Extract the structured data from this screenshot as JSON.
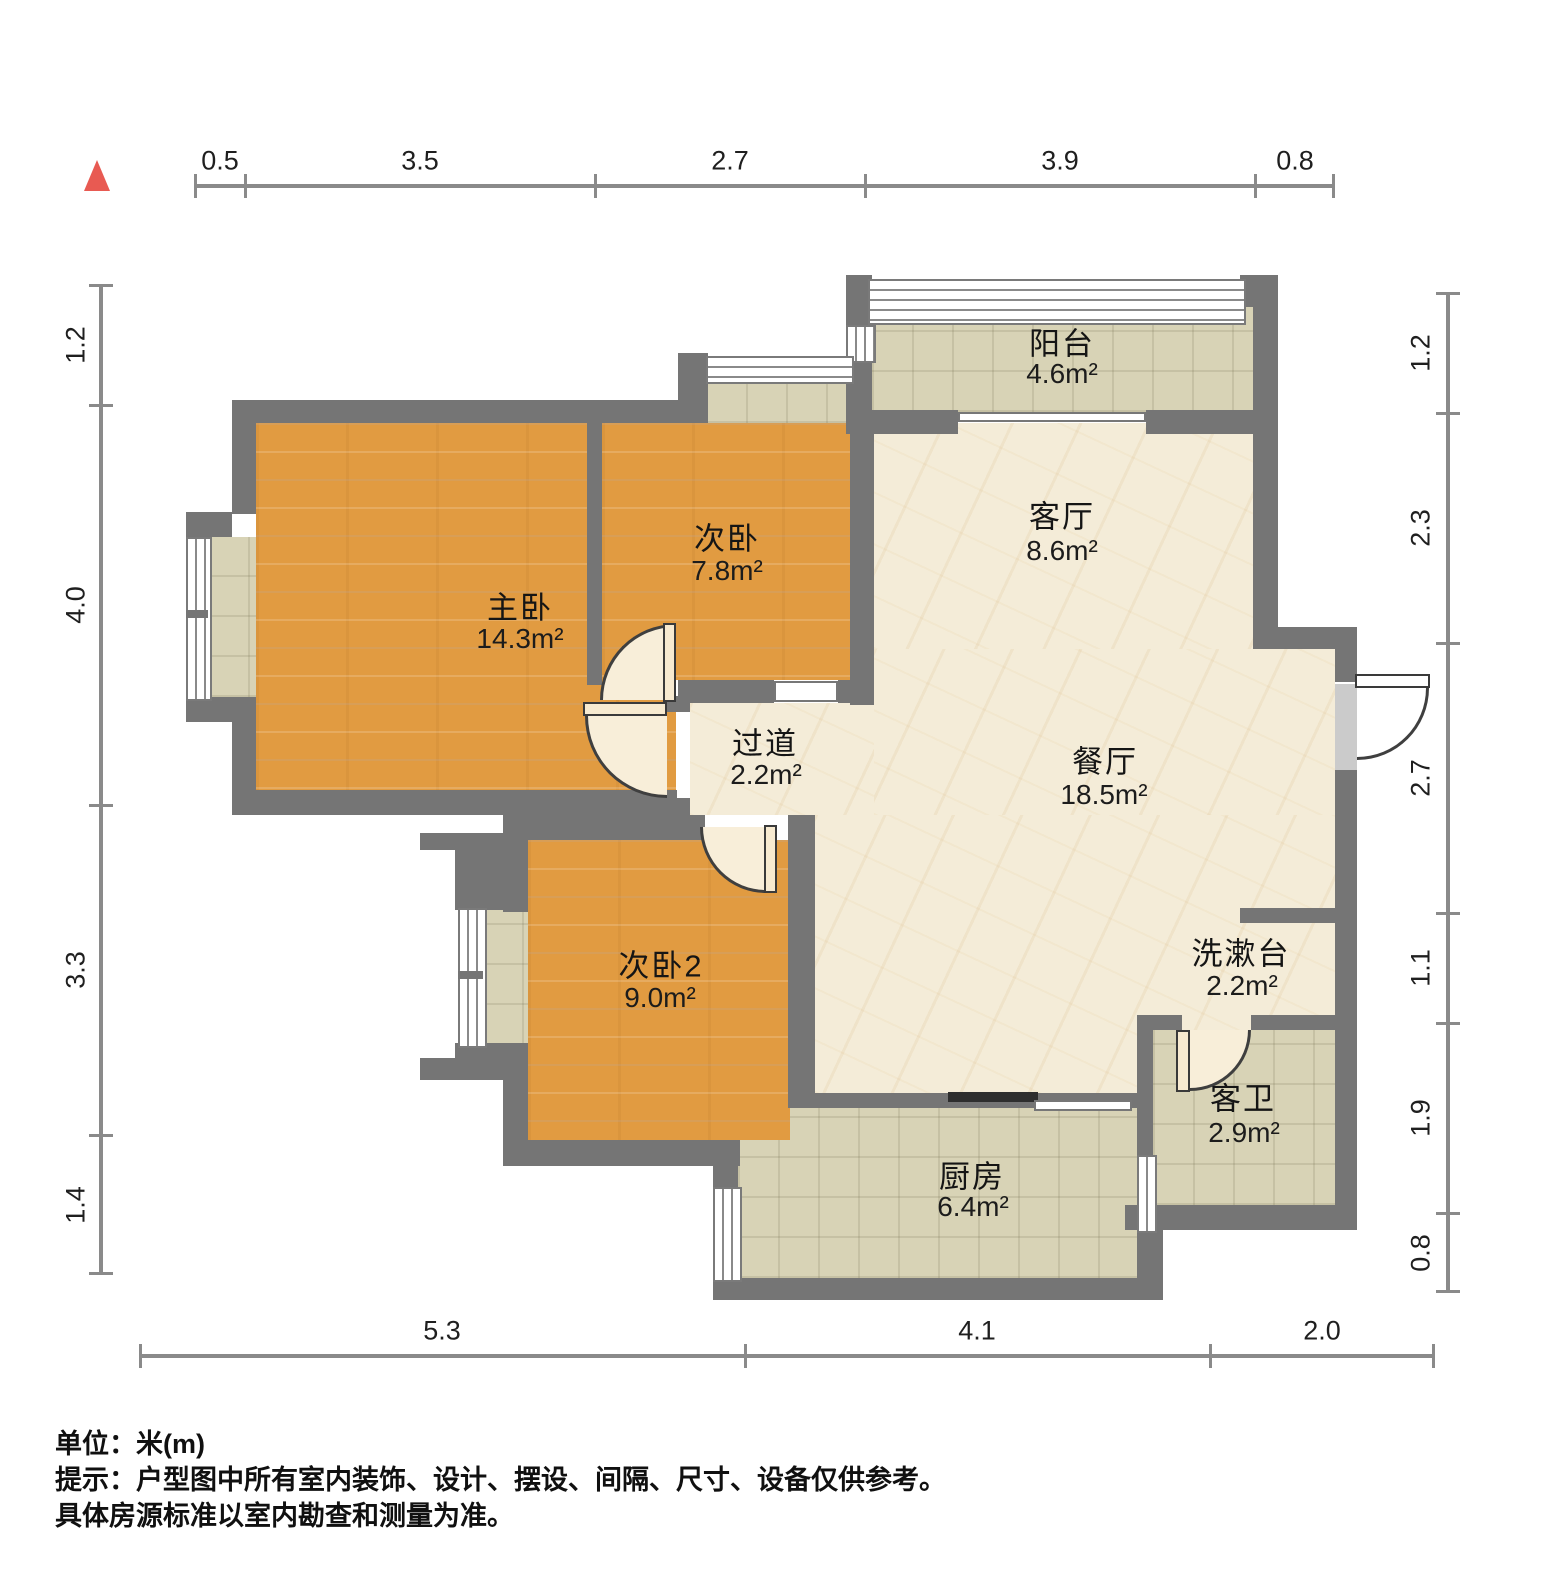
{
  "footer": {
    "unit_line": "单位：米(m)",
    "note_line1": "提示：户型图中所有室内装饰、设计、摆设、间隔、尺寸、设备仅供参考。",
    "note_line2": "具体房源标准以室内勘查和测量为准。"
  },
  "rooms": [
    {
      "id": "balcony",
      "name": "阳台",
      "area": "4.6m²"
    },
    {
      "id": "living",
      "name": "客厅",
      "area": "8.6m²"
    },
    {
      "id": "master",
      "name": "主卧",
      "area": "14.3m²"
    },
    {
      "id": "bedroom2",
      "name": "次卧",
      "area": "7.8m²"
    },
    {
      "id": "hallway",
      "name": "过道",
      "area": "2.2m²"
    },
    {
      "id": "dining",
      "name": "餐厅",
      "area": "18.5m²"
    },
    {
      "id": "bedroom3",
      "name": "次卧2",
      "area": "9.0m²"
    },
    {
      "id": "washstand",
      "name": "洗漱台",
      "area": "2.2m²"
    },
    {
      "id": "bathroom",
      "name": "客卫",
      "area": "2.9m²"
    },
    {
      "id": "kitchen",
      "name": "厨房",
      "area": "6.4m²"
    }
  ],
  "dimensions": {
    "top": [
      "0.5",
      "3.5",
      "2.7",
      "3.9",
      "0.8"
    ],
    "left": [
      "1.2",
      "4.0",
      "3.3",
      "1.4"
    ],
    "right": [
      "1.2",
      "2.3",
      "2.7",
      "1.1",
      "1.9",
      "0.8"
    ],
    "bottom": [
      "5.3",
      "4.1",
      "2.0"
    ]
  },
  "colors": {
    "wall": "#757575",
    "wood_floor": "#e19b41",
    "marble_floor": "#f4ecd8",
    "tile_floor": "#d8d3b6",
    "door": "#f7ead0",
    "compass": "#e85a52"
  }
}
